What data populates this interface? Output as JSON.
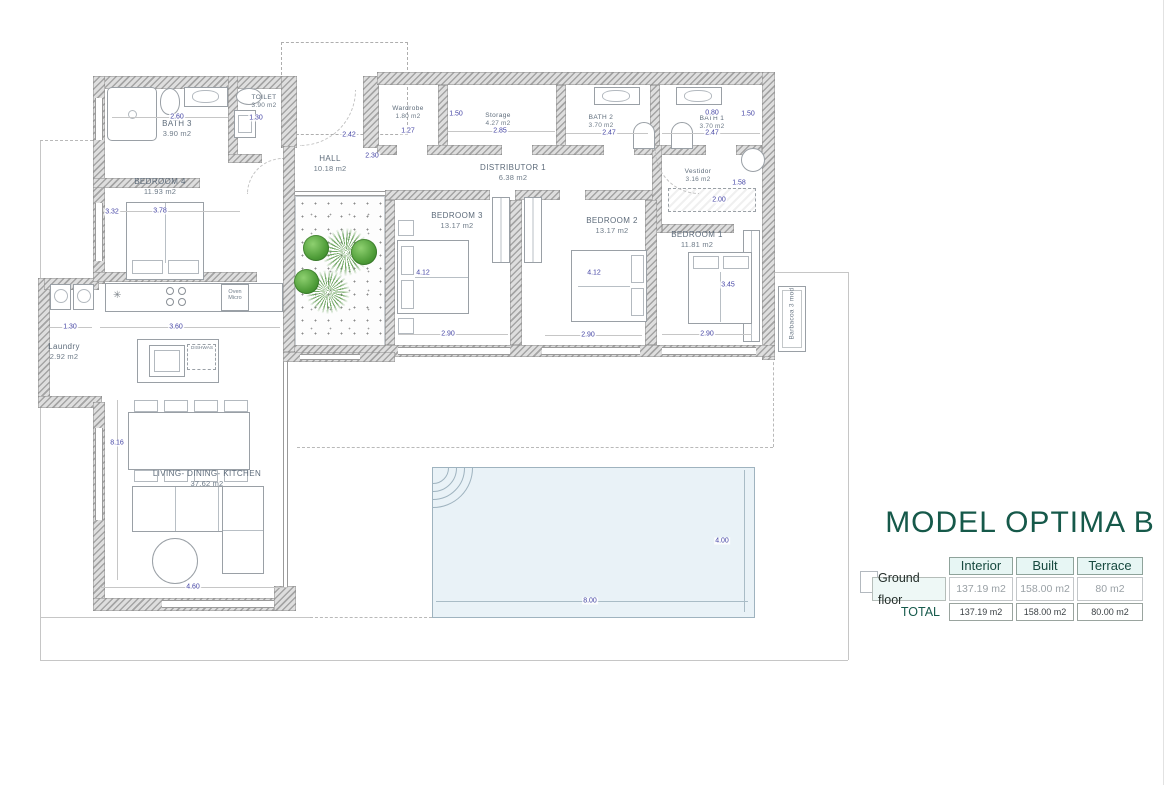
{
  "title": "MODEL OPTIMA B",
  "summary_table": {
    "col_headers": [
      "Interior",
      "Built",
      "Terrace"
    ],
    "rows": [
      {
        "label": "Ground floor",
        "values": [
          "137.19  m2",
          "158.00  m2",
          "80  m2"
        ]
      },
      {
        "label": "TOTAL",
        "values": [
          "137.19 m2",
          "158.00 m2",
          "80.00 m2"
        ]
      }
    ]
  },
  "rooms": {
    "bath3": {
      "name": "BATH 3",
      "area": "3.90  m2"
    },
    "toilet": {
      "name": "TOILET",
      "area": "3.90  m2"
    },
    "hall": {
      "name": "HALL",
      "area": "10.18  m2"
    },
    "wardrobe": {
      "name": "Wardrobe",
      "area": "1.80  m2"
    },
    "storage": {
      "name": "Storage",
      "area": "4.27  m2"
    },
    "distributor": {
      "name": "DISTRIBUTOR 1",
      "area": "6.38 m2"
    },
    "bath2": {
      "name": "BATH 2",
      "area": "3.70  m2"
    },
    "bath1": {
      "name": "BATH 1",
      "area": "3.70 m2"
    },
    "vestidor": {
      "name": "Vestidor",
      "area": "3.16  m2"
    },
    "bedroom4": {
      "name": "BEDROOM 4",
      "area": "11.93  m2"
    },
    "bedroom3": {
      "name": "BEDROOM 3",
      "area": "13.17  m2"
    },
    "bedroom2": {
      "name": "BEDROOM 2",
      "area": "13.17  m2"
    },
    "bedroom1": {
      "name": "BEDROOM 1",
      "area": "11.81  m2"
    },
    "laundry": {
      "name": "Laundry",
      "area": "2.92  m2"
    },
    "living": {
      "name": "LIVING-  DINING- KITCHEN",
      "area": "37.62  m2"
    }
  },
  "dims": {
    "bath3_w": "2.60",
    "toilet_w": "1.30",
    "hall_w": "2.42",
    "hall_h": "2.30",
    "wardrobe_w": "1.27",
    "wardrobe_h": "1.50",
    "storage_w": "2.85",
    "bath2_w": "2.47",
    "bath1_top": "0.80",
    "bath1_w": "2.47",
    "bath1_h": "1.50",
    "vestidor_h": "1.58",
    "vestidor_w": "2.00",
    "bed4_h": "3.32",
    "bed4_w": "3.78",
    "bed3_h": "4.12",
    "bed3_w": "2.90",
    "bed2_h": "4.12",
    "bed2_w": "2.90",
    "bed1_h": "3.45",
    "bed1_w": "2.90",
    "laundry_w": "1.30",
    "kitchen_w": "3.60",
    "living_h": "8.16",
    "living_w": "4.60",
    "pool_w": "8.00",
    "pool_h": "4.00"
  },
  "labels": {
    "barbacoa": "Barbacoa  3  mod",
    "oven": "Oven",
    "micro": "Micro",
    "dishwasher": "DISHWAS"
  },
  "icons": {
    "sink_star": "✳"
  },
  "colors": {
    "title_green": "#16594a",
    "dim_blue": "#4545a5",
    "wall_gray": "#a4a4a4",
    "pool_fill": "#e9f2f7",
    "plant_green": "#4e9c38",
    "table_header_bg": "#e7f6f4"
  }
}
